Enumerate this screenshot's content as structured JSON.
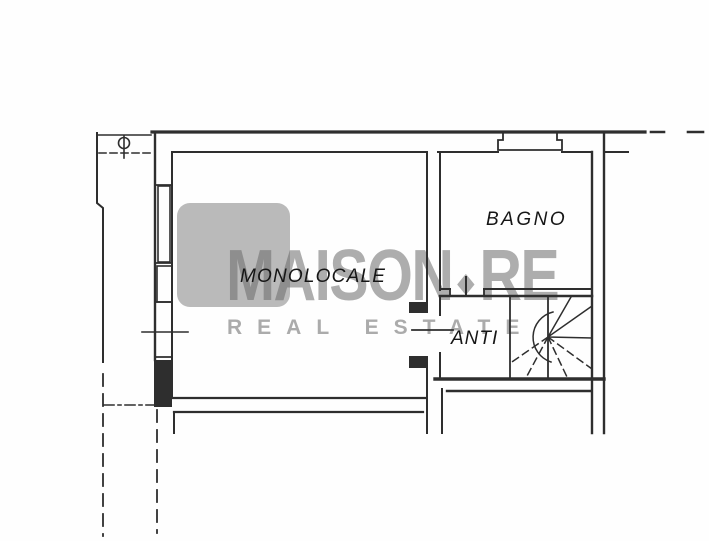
{
  "plan": {
    "rooms": [
      {
        "id": "monolocale",
        "label": "MONOLOCALE"
      },
      {
        "id": "bagno",
        "label": "BAGNO"
      },
      {
        "id": "anti",
        "label": "ANTI"
      }
    ],
    "ink_color": "#2e2e2e"
  },
  "watermark": {
    "brand_main": "MAISON",
    "brand_suffix": "RE",
    "tagline": "REAL ESTATE",
    "square_color": "#bababa",
    "brand_color": "rgba(105,105,105,0.55)",
    "tagline_color": "#ababab"
  }
}
